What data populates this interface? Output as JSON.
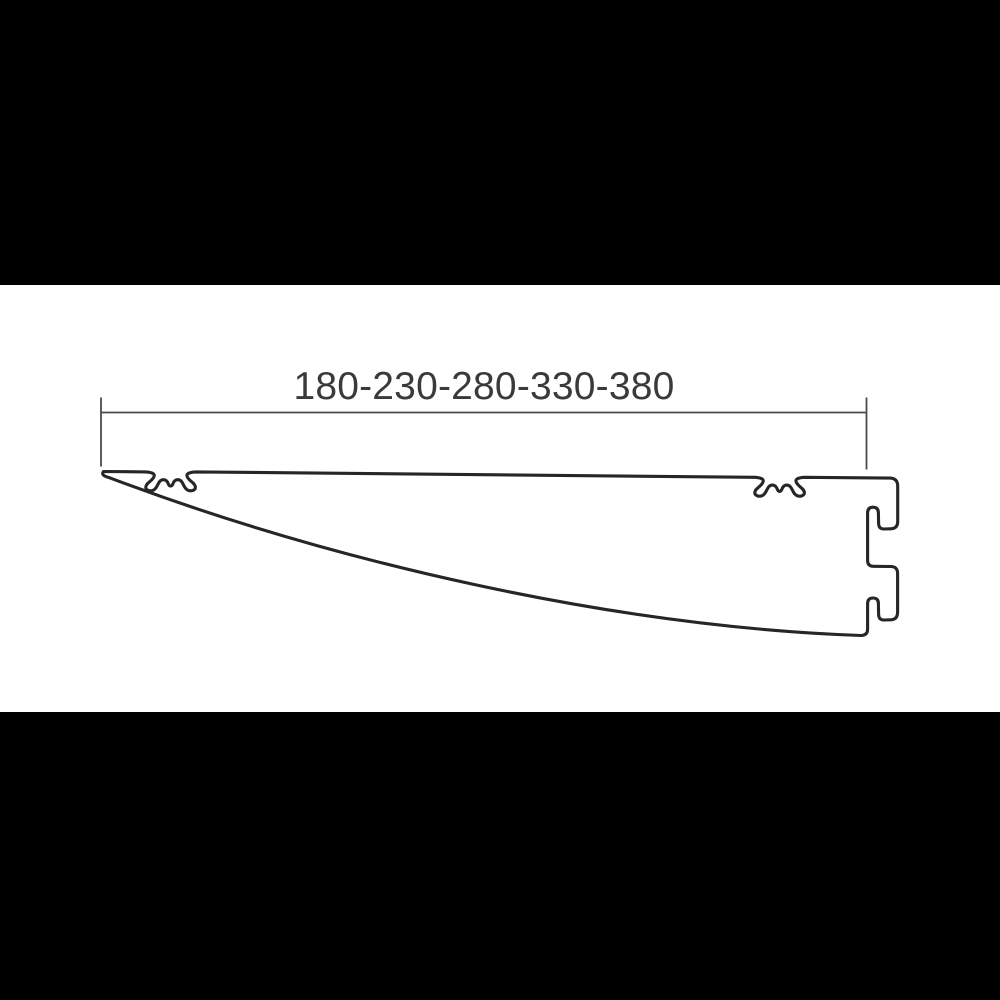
{
  "diagram": {
    "dimension_label": "180-230-280-330-380",
    "lengths_mm": [
      180,
      230,
      280,
      330,
      380
    ],
    "subject": "shelf-bracket-side-profile"
  },
  "colors": {
    "letterbox": "#000000",
    "background": "#ffffff",
    "outline": "#262626",
    "dimension": "#4a4a4a",
    "text": "#3a3a3a"
  }
}
